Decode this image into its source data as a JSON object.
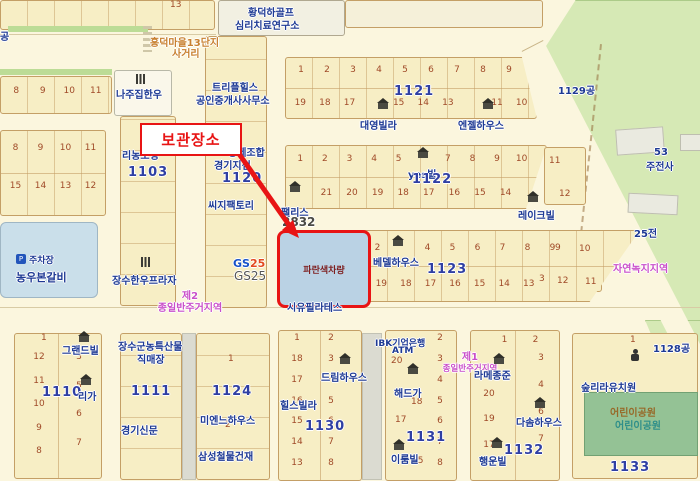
{
  "colors": {
    "road": "#FBF6DE",
    "block": "#F7EEC5",
    "block_border": "#C49F66",
    "parcel_number": "#A04A28",
    "poi_blue": "#1E3A94",
    "block_number_blue": "#2F3FA3",
    "zone_magenta": "#C94FC9",
    "annotation_red": "#E81414",
    "highlight_fill": "#BAD2E4",
    "forest_green": "#D6E9B5",
    "park_green": "#94C295"
  },
  "icons": {
    "house": "house-icon",
    "restaurant": "fork-knife-icon",
    "person": "person-icon",
    "parking": "parking-P-icon",
    "arrow": "red-arrow"
  },
  "marker": {
    "label": "보관장소"
  },
  "highlight": {
    "label": "파란색차량",
    "sublabel": "시유필라테스"
  },
  "zones": {
    "zone2_line1": "제2",
    "zone2_line2": "종일반주거지역",
    "zone1_line1": "제1",
    "zone1_line2": "종일반주거지역",
    "green_zone": "자연녹지지역"
  },
  "misc": {
    "top_parcel": "13",
    "gong": "공"
  },
  "pois": {
    "golf1": "황덕하골프",
    "golf2": "심리치료연구소",
    "intersection1": "흥덕마을13단지",
    "intersection2": "사거리",
    "najip": "나주집한우",
    "triple1": "트리플힐스",
    "triple2": "공인중개사사무소",
    "gongje1": "공제조합",
    "gongje2": "경기지점",
    "cg": "씨지팩토리",
    "rinong": "리농조명",
    "gs_a": "GS",
    "gs_b": "25",
    "gs_text": "GS25",
    "palace": "팰리스",
    "palace_num": "2832",
    "daeyoung": "대영빌라",
    "angel": "엔젤하우스",
    "yesvil": "yes빌",
    "lakevil": "레이크빌",
    "bethel": "베델하우스",
    "jujeonsa_num": "53",
    "jujeonsa": "주전사",
    "field25": "25전",
    "g1129": "1129공",
    "g1128": "1128공",
    "nongwoo": "농우본갈비",
    "parking": "주차장",
    "hanwoo_plaza": "장수한우프라자",
    "grand": "그랜드빌",
    "riga": "리가",
    "mart1": "장수군농특산물",
    "mart2": "직매장",
    "news": "경기신문",
    "mienne": "미엔느하우스",
    "samsung": "삼성철물건재",
    "dream": "드림하우스",
    "hills": "힐스빌라",
    "ibk1": "IBK기업은행",
    "ibk2": "ATM",
    "haedeu": "해드가",
    "iroom": "이룸빌",
    "lameson": "라메종준",
    "dasom": "다솜하우스",
    "haengun": "행운빌",
    "kinder": "숲리라유치원",
    "park_name": "어린이공원",
    "park_label": "어린이공원"
  },
  "blocks": {
    "left_top": {
      "row": [
        "8",
        "9",
        "10",
        "11"
      ]
    },
    "left_mid": {
      "r1": [
        "8",
        "9",
        "10",
        "11"
      ],
      "r2": [
        "15",
        "14",
        "13",
        "12"
      ]
    },
    "b1103": {
      "num": "1103"
    },
    "b1110": {
      "num": "1110",
      "n1": "1",
      "col_left": [
        "12",
        "11",
        "10",
        "9",
        "8"
      ],
      "col_right": [
        "3",
        "5",
        "6",
        "7"
      ]
    },
    "b1111": {
      "num": "1111"
    },
    "b1120": {
      "num": "1120"
    },
    "b1121": {
      "num": "1121",
      "r1": [
        "1",
        "2",
        "3",
        "4",
        "5",
        "6",
        "7",
        "8",
        "9"
      ],
      "r2": [
        "19",
        "18",
        "17",
        "",
        "15",
        "14",
        "13",
        "",
        "11",
        "10"
      ]
    },
    "b1122": {
      "num": "1122",
      "r1": [
        "1",
        "2",
        "3",
        "4",
        "5",
        "",
        "7",
        "8",
        "9",
        "10"
      ],
      "r2": [
        "",
        "21",
        "20",
        "19",
        "18",
        "17",
        "16",
        "15",
        "14",
        ""
      ]
    },
    "b1123": {
      "num": "1123",
      "r1": [
        "2",
        "",
        "4",
        "5",
        "6",
        "7",
        "8",
        "9"
      ],
      "r2": [
        "19",
        "18",
        "17",
        "16",
        "15",
        "14",
        "13"
      ]
    },
    "b1124": {
      "num": "1124",
      "n1": "1",
      "n2": "2"
    },
    "b1130": {
      "num": "1130",
      "col_left": [
        "1",
        "18",
        "17",
        "16",
        "15",
        "14",
        "13"
      ],
      "col_right": [
        "2",
        "3",
        "4",
        "5",
        "6",
        "7",
        "8"
      ]
    },
    "b1131": {
      "num": "1131",
      "n20": "20",
      "n18": "18",
      "n17": "17",
      "n15": "15",
      "col_right": [
        "2",
        "3",
        "4",
        "5",
        "6",
        "7",
        "8"
      ]
    },
    "b1132": {
      "num": "1132",
      "top_row": [
        "1",
        "2"
      ],
      "col_left": [
        "21",
        "20",
        "19",
        "17"
      ],
      "col_right": [
        "3",
        "4",
        "6",
        "7"
      ]
    },
    "b1133": {
      "num": "1133",
      "n1": "1",
      "row": [
        "17",
        "16",
        "3"
      ]
    },
    "loose": {
      "a": "11",
      "b": "12",
      "c": "9",
      "d": "10",
      "e": "3",
      "f": "12",
      "g": "11"
    }
  }
}
